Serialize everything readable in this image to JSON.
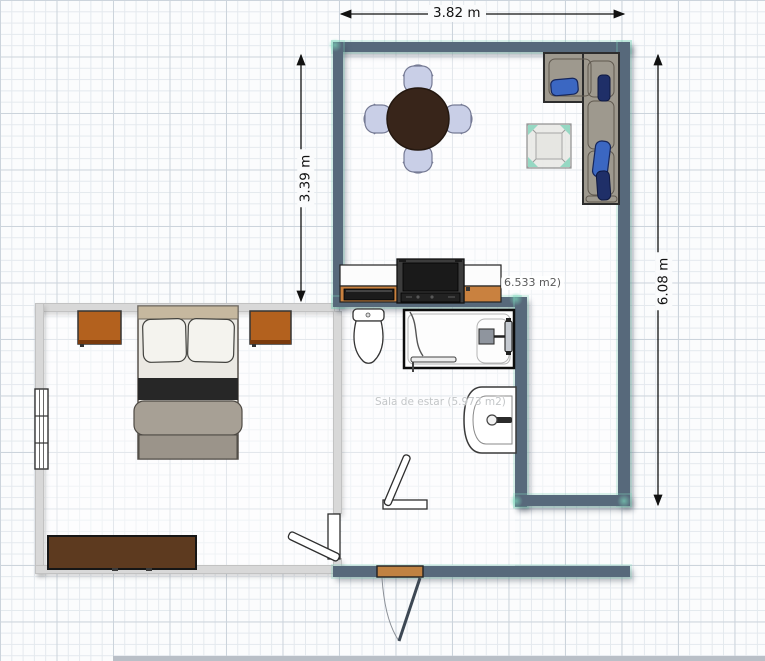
{
  "app": {
    "type": "floor-plan-editor",
    "view": "2d-plan"
  },
  "canvas": {
    "width": 765,
    "height": 661
  },
  "dimensions": [
    {
      "id": "top-width",
      "label": "3.82 m",
      "orientation": "horizontal"
    },
    {
      "id": "left-height",
      "label": "3.39 m",
      "orientation": "vertical"
    },
    {
      "id": "right-height",
      "label": "6.08 m",
      "orientation": "vertical"
    }
  ],
  "room_labels": [
    {
      "id": "living-area",
      "text": "6.533 m2)"
    },
    {
      "id": "sala-de-estar",
      "text": "Sala de estar (5.973 m2)"
    }
  ],
  "furniture": [
    "dining-table",
    "dining-chair-top",
    "dining-chair-right",
    "dining-chair-bottom",
    "dining-chair-left",
    "sectional-sofa",
    "sofa-pillows",
    "coffee-table",
    "tv-console",
    "tv",
    "bed",
    "pillows",
    "nightstand-left",
    "nightstand-right",
    "dresser",
    "window-radiator",
    "toilet",
    "shower-tub",
    "sink",
    "door-bedroom",
    "door-bathroom",
    "entrance-door"
  ],
  "colors": {
    "wall_dark": "#57697b",
    "wall_light": "#d8d8d8",
    "selection_teal": "#8fdcc3",
    "grid_minor": "#e4e9ee",
    "grid_major": "#ccd4dc",
    "table_brown": "#38251a",
    "chair_seat": "#c9cfe7",
    "sofa_body": "#9e998e",
    "pillow_blue": "#3b67c2",
    "pillow_navy": "#1f2f68",
    "console_wood": "#c9813f",
    "tv_black": "#1a1a1a",
    "nightstand_brown": "#b3611e",
    "dresser_brown": "#5d3a1f",
    "headboard_tan": "#c6b89f",
    "blanket_black": "#272727",
    "blanket_gray": "#a7a095",
    "entrance_threshold": "#c08242",
    "dimension_text": "#111111",
    "area_label_text": "#5a5a5a",
    "faint_label_text": "#c3c6c8"
  }
}
